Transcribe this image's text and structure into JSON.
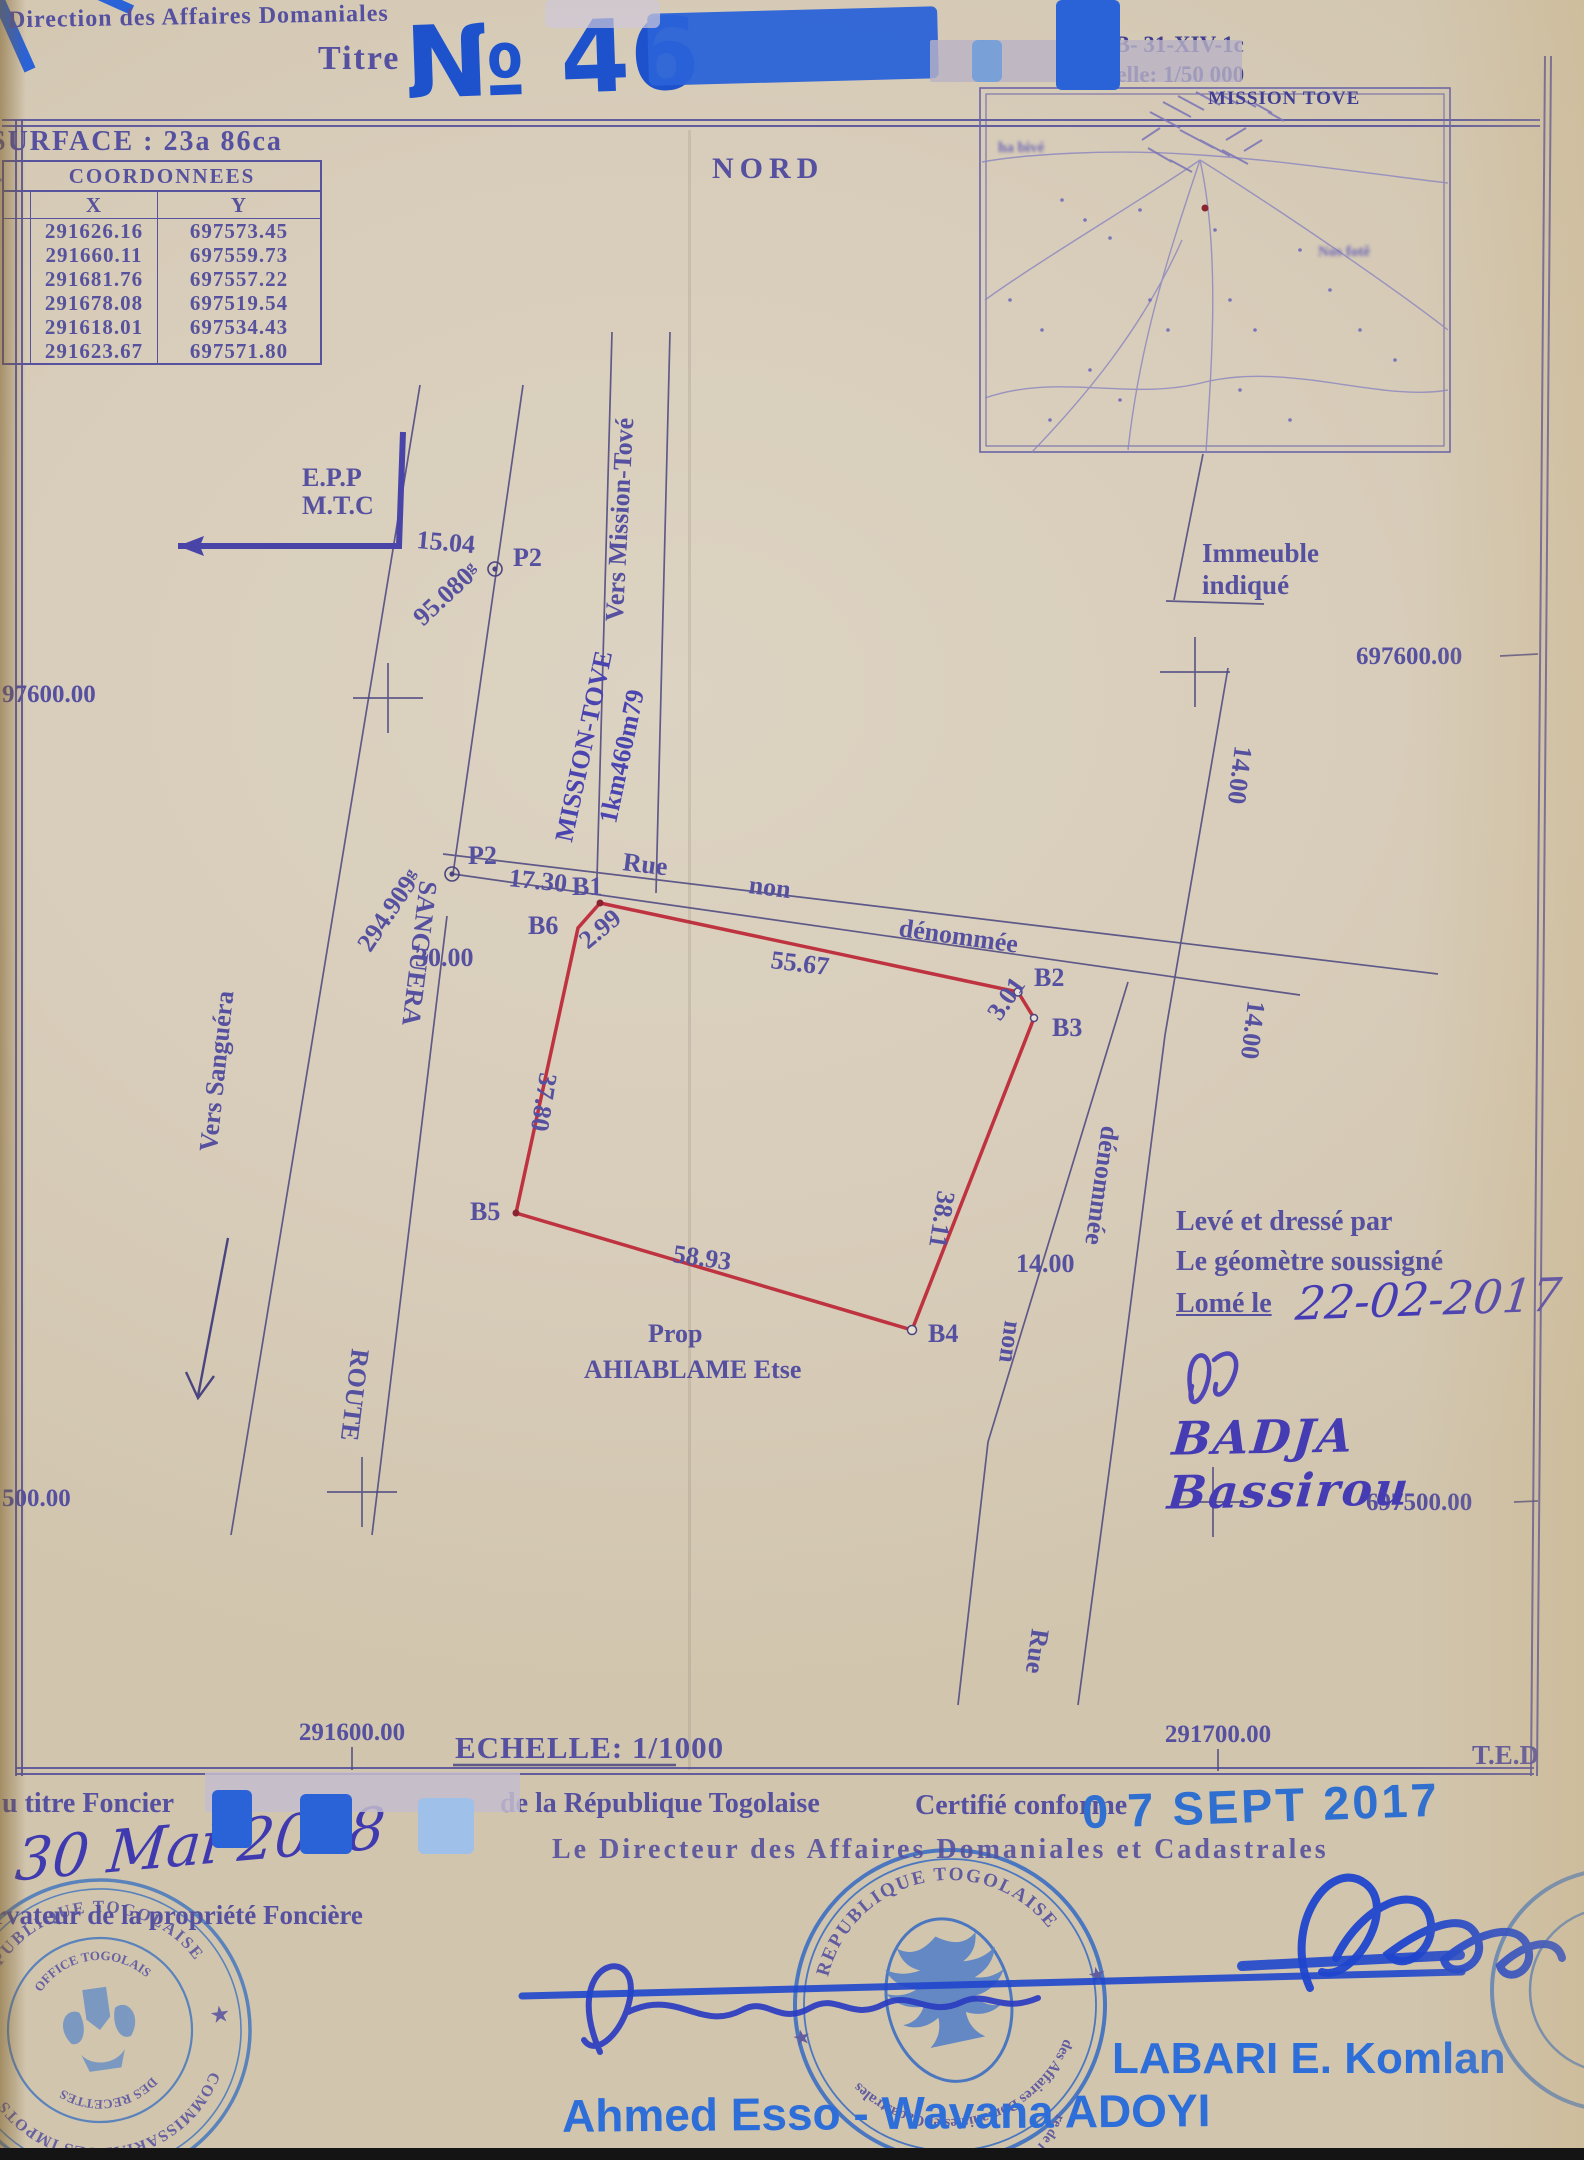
{
  "colors": {
    "paper": "#d8ceba",
    "ink_violet": "#55509f",
    "ink_navy": "#3c3c8c",
    "parcel_red": "#bf3240",
    "pen_blue": "#1d52cc",
    "stamp_blue": "#4377c1",
    "print_blue": "#2e6ed8",
    "date_stamp_blue": "#2f6fd0"
  },
  "header": {
    "direction": "Direction des Affaires Domaniales",
    "titre_label": "Titre",
    "titre_number": "№ 46",
    "nord": "NORD",
    "surface": "SURFACE : 23a 86ca"
  },
  "inset": {
    "sheet_ref": "NB- 31-XIV-1c",
    "scale": "Echelle: 1/50 000",
    "village": "MISSION TOVE",
    "label_left": "ha bivé",
    "label_right": "Nos fotê"
  },
  "coords_table": {
    "title": "COORDONNEES",
    "col_x": "X",
    "col_y": "Y",
    "rows": [
      {
        "x": "291626.16",
        "y": "697573.45"
      },
      {
        "x": "291660.11",
        "y": "697559.73"
      },
      {
        "x": "291681.76",
        "y": "697557.22"
      },
      {
        "x": "291678.08",
        "y": "697519.54"
      },
      {
        "x": "291618.01",
        "y": "697534.43"
      },
      {
        "x": "291623.67",
        "y": "697571.80"
      }
    ]
  },
  "plan": {
    "epp": "E.P.P",
    "mtc": "M.T.C",
    "p2": "P2",
    "d_15_04": "15.04",
    "bearing_95": "95.080ᵍ",
    "bearing_294": "294.909ᵍ",
    "d_17_30": "17.30",
    "d_30_00": "30.00",
    "rue": "Rue",
    "non": "non",
    "denommee": "dénommée",
    "b1": "B1",
    "b2": "B2",
    "b3": "B3",
    "b4": "B4",
    "b5": "B5",
    "b6": "B6",
    "d_2_99": "2.99",
    "d_55_67": "55.67",
    "d_3_01": "3.01",
    "d_38_11": "38.11",
    "d_58_93": "58.93",
    "d_37_80": "37.80",
    "d_14_00": "14.00",
    "mission_tove": "MISSION-TOVE",
    "mission_tove_dist": "1km460m79",
    "vers_mission_tove": "Vers Mission-Tové",
    "vers_sanguera": "Vers Sanguéra",
    "route": "ROUTE",
    "sanguera": "SANGUERA",
    "immeuble": "Immeuble",
    "indique": "indiqué",
    "prop": "Prop",
    "owner": "AHIABLAME Etse",
    "grid_y_left_top": "97600.00",
    "grid_y_right_top": "697600.00",
    "grid_y_left_bottom": "500.00",
    "grid_y_right_bottom": "697500.00",
    "grid_x_left": "291600.00",
    "grid_x_right": "291700.00",
    "scale": "ECHELLE: 1/1000",
    "ted": "T.E.D"
  },
  "surveyor": {
    "line1": "Levé et dressé par",
    "line2": "Le géomètre soussigné",
    "line3": "Lomé le",
    "date": "22-02-2017",
    "name": "BADJA Bassirou"
  },
  "footer": {
    "titre_foncier": "u titre Foncier",
    "republique": "de la République Togolaise",
    "certifie": "Certifié conforme",
    "date_stamp": "0 7 SEPT 2017",
    "directeur": "Le Directeur des Affaires Domaniales et Cadastrales",
    "date_hand": "30 Mai 2018",
    "conservateur": "rvateur de la propriété Foncière",
    "signer_left": "Ahmed Esso - Wavana ADOYI",
    "signer_right": "LABARI E. Komlan"
  },
  "stamps": {
    "left": {
      "outer_top": "REPUBLIQUE TOGOLAISE",
      "outer_bottom": "COMMISSARIAT DES IMPOTS",
      "inner_top": "OFFICE TOGOLAIS",
      "inner_bottom": "DES RECETTES",
      "star": "★"
    },
    "center": {
      "outer_top": "REPUBLIQUE TOGOLAISE",
      "mid": "des Affaires Domaniales et Cadastrales",
      "outer_bottom": "re de l'Economie et des Finances",
      "star": "★"
    }
  }
}
